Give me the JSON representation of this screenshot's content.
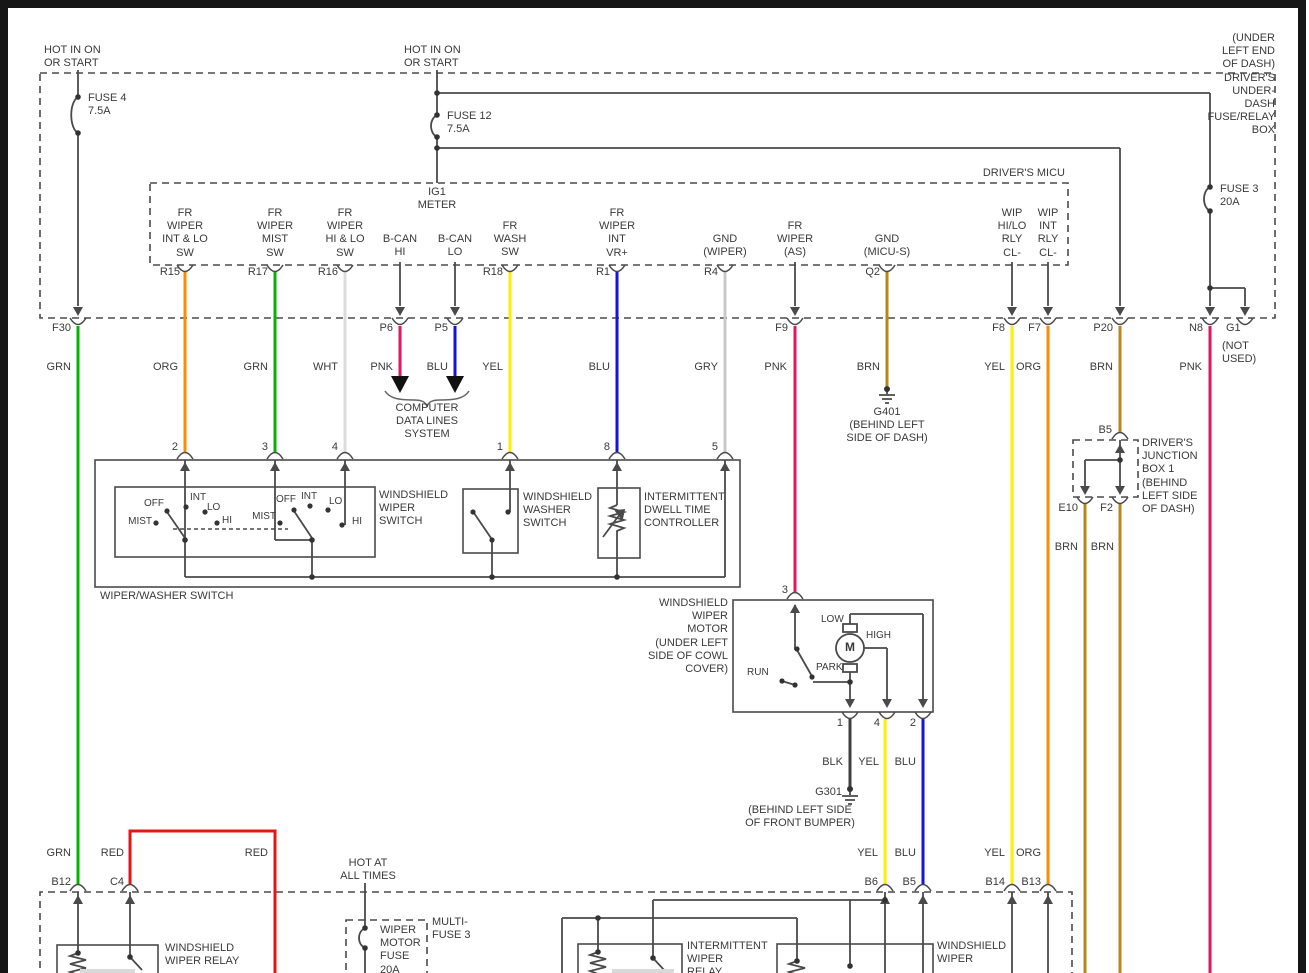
{
  "colors": {
    "green": "#00b400",
    "orange": "#ff8c00",
    "white_wire": "#dcdcdc",
    "pink": "#e8145a",
    "blue": "#1414dc",
    "yellow": "#ffee00",
    "gray_wire": "#c8c8c8",
    "brown": "#b78718",
    "black_wire": "#404040",
    "red": "#e81414",
    "line": "#4a4a4a",
    "text": "#3a3a3a"
  },
  "top": {
    "hot_left": "HOT IN ON\nOR START",
    "hot_mid": "HOT IN ON\nOR START",
    "box_title": "(UNDER LEFT END OF DASH)\nDRIVER'S UNDER-DASH\nFUSE/RELAY BOX",
    "fuse4": "FUSE 4\n7.5A",
    "fuse12": "FUSE 12\n7.5A",
    "fuse3": "FUSE 3\n20A"
  },
  "micu": {
    "title": "DRIVER'S MICU",
    "ig1": "IG1\nMETER",
    "pins": [
      {
        "label": "FR\nWIPER\nINT & LO\nSW"
      },
      {
        "label": "FR\nWIPER\nMIST\nSW"
      },
      {
        "label": "FR\nWIPER\nHI & LO\nSW"
      },
      {
        "label": "B-CAN\nHI"
      },
      {
        "label": "B-CAN\nLO"
      },
      {
        "label": "FR\nWASH\nSW"
      },
      {
        "label": "FR\nWIPER\nINT\nVR+"
      },
      {
        "label": "GND\n(WIPER)"
      },
      {
        "label": "FR\nWIPER\n(AS)"
      },
      {
        "label": "GND\n(MICU-S)"
      },
      {
        "label": "WIP\nHI/LO\nRLY\nCL-"
      },
      {
        "label": "WIP\nINT\nRLY\nCL-"
      }
    ],
    "edge_connectors": [
      "R15",
      "R17",
      "R16",
      "R18",
      "R1",
      "R4",
      "Q2"
    ],
    "box_connectors": [
      "F30",
      "P6",
      "P5",
      "F9",
      "F8",
      "F7",
      "P20",
      "N8",
      "G1"
    ],
    "g1_note": "(NOT\nUSED)"
  },
  "wire_labels": [
    "GRN",
    "ORG",
    "GRN",
    "WHT",
    "PNK",
    "BLU",
    "YEL",
    "BLU",
    "GRY",
    "PNK",
    "BRN",
    "YEL",
    "ORG",
    "BRN",
    "PNK"
  ],
  "data_lines": {
    "label": "COMPUTER\nDATA LINES\nSYSTEM"
  },
  "g401": {
    "label": "G401\n(BEHIND LEFT\nSIDE OF DASH)"
  },
  "switch": {
    "pins": [
      "2",
      "3",
      "4",
      "1",
      "8",
      "5"
    ],
    "box_label": "WIPER/WASHER SWITCH",
    "wiper_label": "WINDSHIELD\nWIPER\nSWITCH",
    "washer_label": "WINDSHIELD\nWASHER\nSWITCH",
    "dwell_label": "INTERMITTENT\nDWELL TIME\nCONTROLLER",
    "g1": {
      "off": "OFF",
      "int": "INT",
      "lo": "LO",
      "mist": "MIST",
      "hi": "HI"
    },
    "g2": {
      "off": "OFF",
      "int": "INT",
      "lo": "LO",
      "mist": "MIST",
      "hi": "HI"
    }
  },
  "motor": {
    "pin3": "3",
    "label": "WINDSHIELD\nWIPER\nMOTOR\n(UNDER LEFT\nSIDE OF COWL\nCOVER)",
    "low": "LOW",
    "high": "HIGH",
    "park": "PARK",
    "run": "RUN",
    "m": "M",
    "pins": [
      "1",
      "4",
      "2"
    ],
    "wire_labels": [
      "BLK",
      "YEL",
      "BLU"
    ],
    "gnd": "G301",
    "gnd_loc": "(BEHIND LEFT SIDE\nOF FRONT BUMPER)"
  },
  "junction": {
    "b5": "B5",
    "e10": "E10",
    "f2": "F2",
    "brn1": "BRN",
    "brn2": "BRN",
    "label": "DRIVER'S\nJUNCTION\nBOX 1\n(BEHIND\nLEFT SIDE\nOF DASH)"
  },
  "bottom": {
    "grn": "GRN",
    "red1": "RED",
    "red2": "RED",
    "yel1": "YEL",
    "blu1": "BLU",
    "yel2": "YEL",
    "org2": "ORG",
    "hot": "HOT AT\nALL TIMES",
    "b12": "B12",
    "c4": "C4",
    "b6": "B6",
    "b5": "B5",
    "b14": "B14",
    "b13": "B13",
    "wiper_relay": "WINDSHIELD\nWIPER RELAY",
    "fuse": "WIPER\nMOTOR\nFUSE\n20A",
    "multifuse": "MULTI-\nFUSE 3",
    "int_relay": "INTERMITTENT\nWIPER\nRELAY",
    "right_relay": "WINDSHIELD\nWIPER"
  }
}
